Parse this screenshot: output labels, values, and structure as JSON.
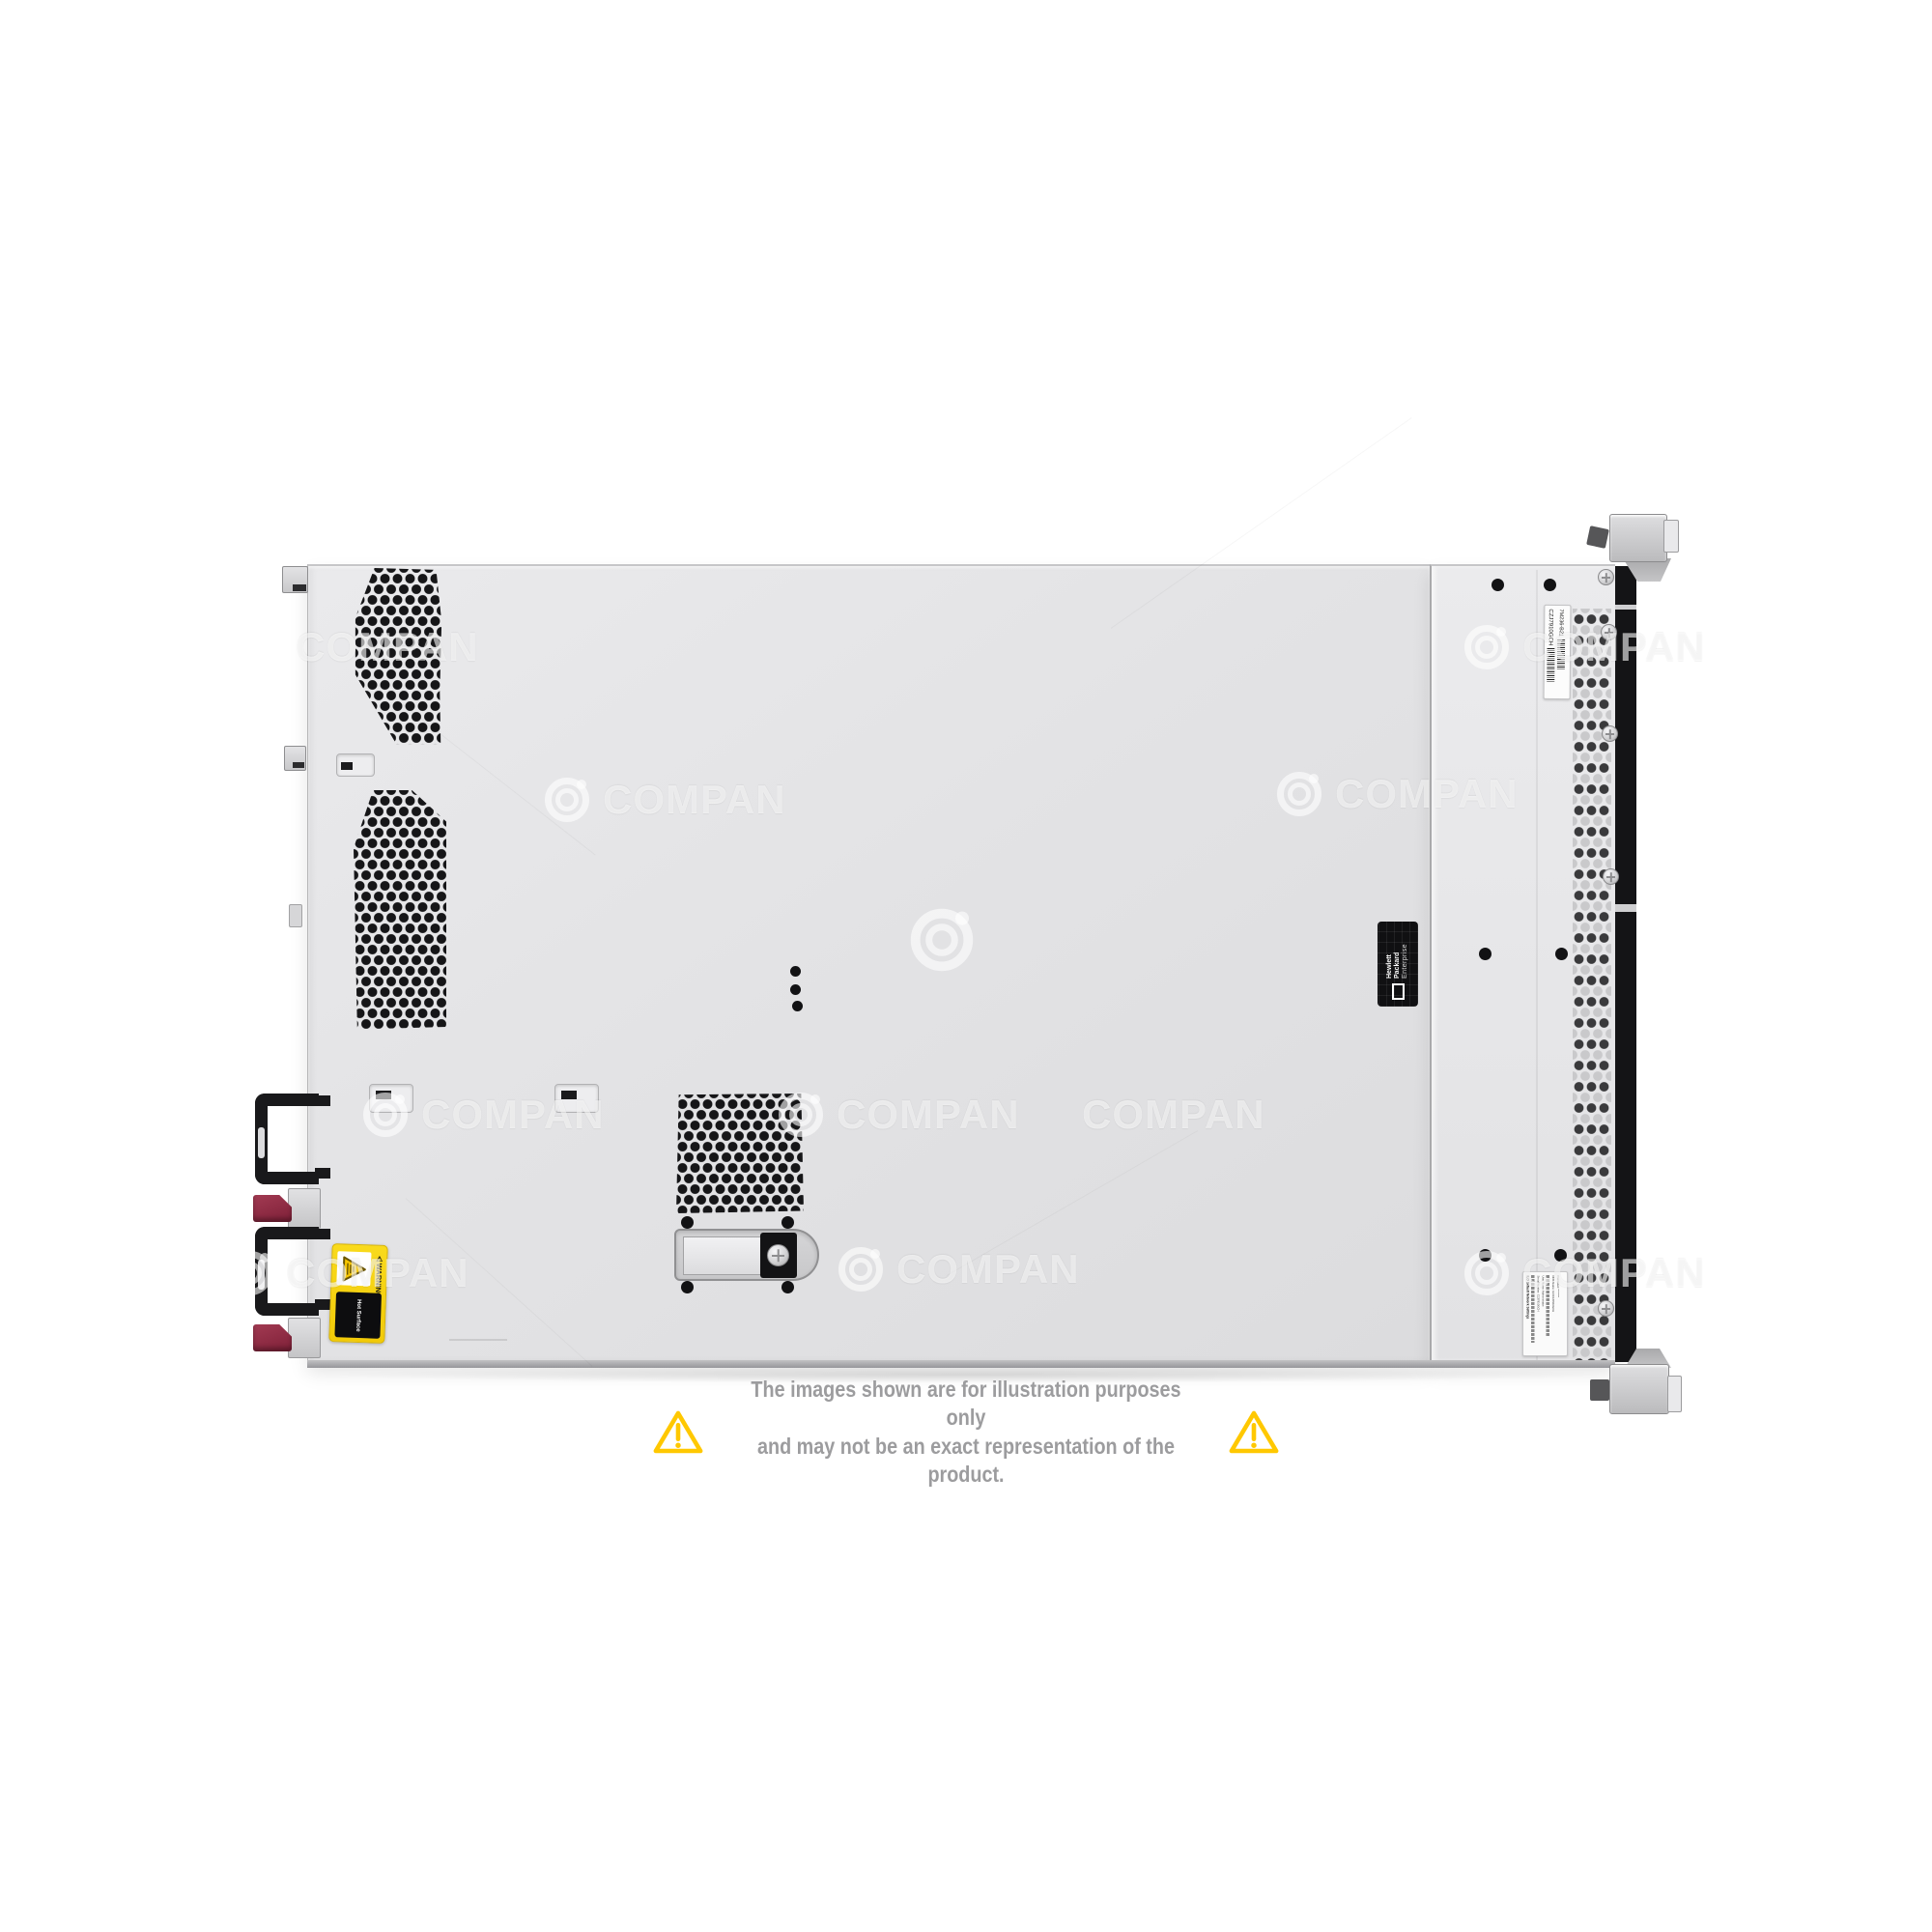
{
  "watermark": {
    "text": "COMPAN"
  },
  "labels": {
    "warning": {
      "glyph": "⚠",
      "heading": "WARNING:",
      "text": "Hot Surface"
    },
    "brand": {
      "line1": "Hewlett Packard",
      "line2": "Enterprise"
    },
    "serial": {
      "serial_number": "CZJ7910GCH",
      "part_number": "7M236-B21"
    },
    "ilo": {
      "title": "iLO Default Network Settings",
      "lines": [
        "Serial Number: CZJ7910GCH",
        "User Name: Administrator",
        "DNS Name: ILOCZJ7910GCH",
        "Password: ********"
      ]
    }
  },
  "disclaimer": {
    "line1": "The images shown are for illustration purposes only",
    "line2": "and may not be an exact representation of the product."
  },
  "icons": {
    "warning_triangle": "warning-triangle-icon",
    "watermark_logo": "watermark-logo-icon",
    "hot_surface_triangle": "hot-surface-triangle-icon"
  },
  "colors": {
    "chassis_gray": "#e3e3e5",
    "bezel_black": "#141416",
    "warning_label_yellow": "#F5CE0A",
    "disclaimer_triangle_yellow": "#FFC800",
    "disclaimer_text_gray": "#9C9C9E",
    "psu_tab_maroon": "#8E3048"
  }
}
